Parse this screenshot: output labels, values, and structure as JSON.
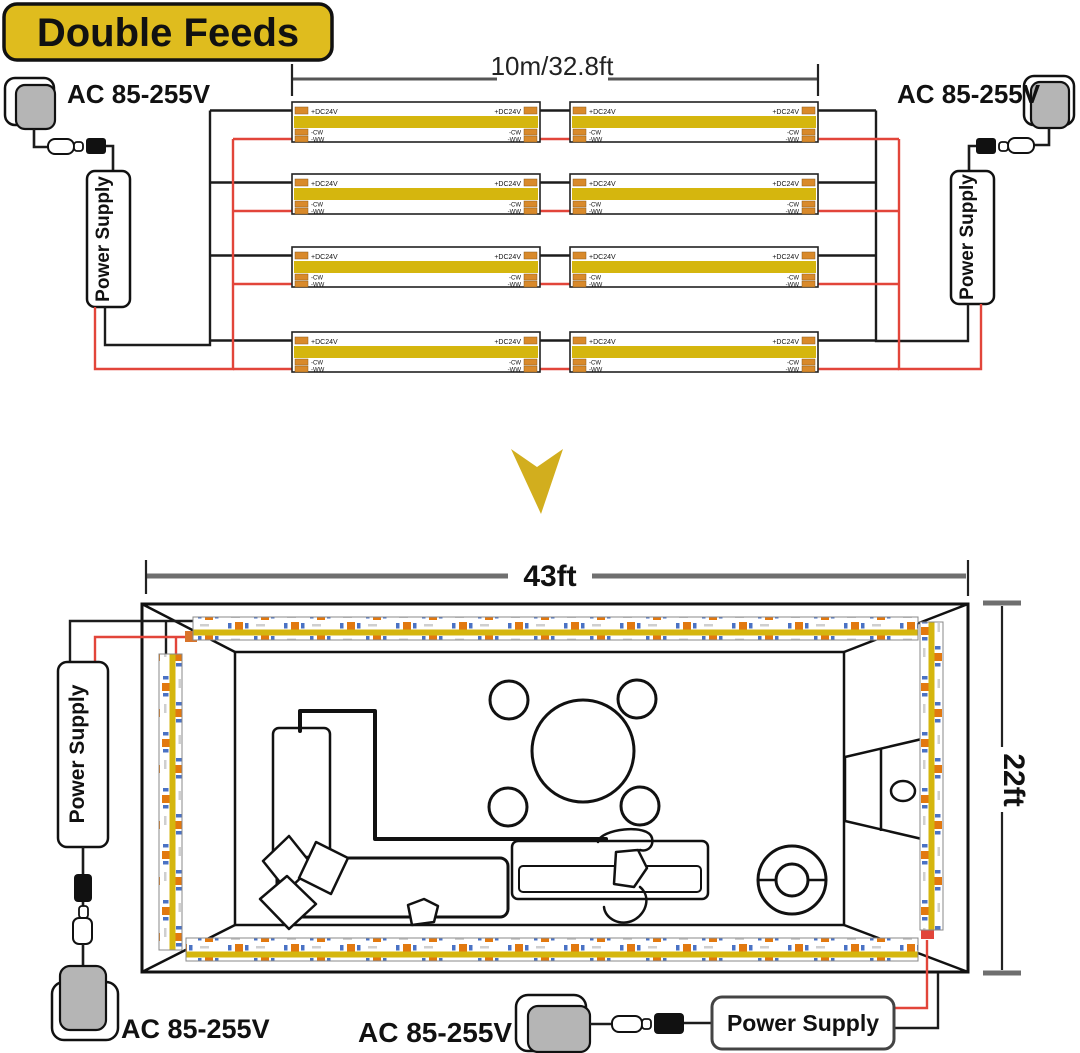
{
  "title": {
    "badge": "Double Feeds"
  },
  "labels": {
    "ac_voltage": "AC 85-255V",
    "power_supply": "Power Supply",
    "strip_length": "10m/32.8ft",
    "room_width": "43ft",
    "room_depth": "22ft"
  },
  "strip_markings": {
    "plus": "+DC24V",
    "cw": "-CW",
    "ww": "-WW"
  },
  "colors": {
    "badge_yellow": "#dfbc1e",
    "strip_yellow": "#d5b60e",
    "wire_red": "#e2453a",
    "wire_black": "#1c1c1c",
    "pad_orange": "#d98a2b",
    "chip_orange": "#e2790f",
    "chip_blue": "#4a72c4",
    "dimension_gray": "#6f6f6f",
    "plug_gray": "#b5b5b5",
    "arrow_yellow": "#d2ae1e"
  }
}
